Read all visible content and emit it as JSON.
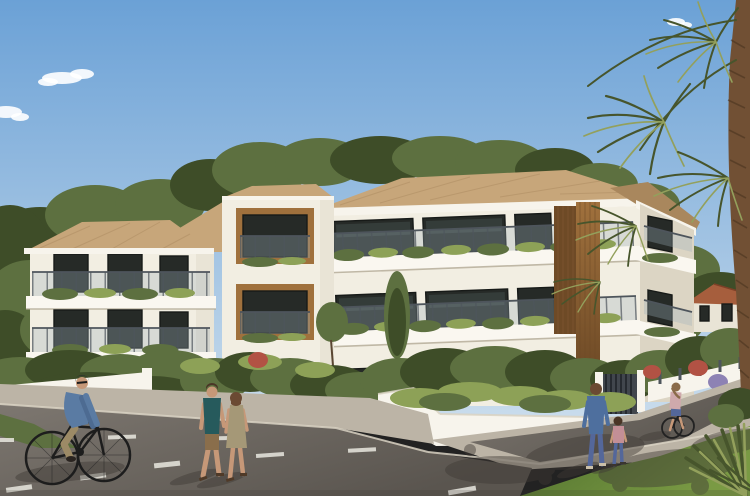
{
  "scene": {
    "setting": "Sunny architectural rendering of a modern three-storey Mediterranean apartment residence on a landscaped street corner",
    "sky": {
      "condition": "clear light-blue sky with a few small white clouds"
    },
    "building": {
      "storeys": 3,
      "facade": "white stucco",
      "roof": "sand-coloured clay tile hip roofs with greenery rising behind the ridges",
      "features": [
        "wrap-around balconies with glass and steel railings",
        "planted balcony edges",
        "vertical timber slat column",
        "timber-framed recessed loggias",
        "large dark-framed windows"
      ]
    },
    "landscape": {
      "elements": [
        "low white garden walls",
        "dense green shrubs and grasses",
        "lavender accents",
        "red flowering shrubs",
        "slim poplar tree",
        "tall fan palm at right edge",
        "agave leaves in the lower-right corner",
        "lawn strip at lower right",
        "grass verge at lower left"
      ]
    },
    "background": {
      "house": "small white house with terracotta tiled roof among trees"
    },
    "street": {
      "surfaces": [
        "asphalt roadway",
        "light concrete sidewalks",
        "corner kerbs"
      ],
      "markings": "white dashed lane lines",
      "shadows": "tree shadows dappling the pavement at lower right"
    },
    "people": [
      {
        "name": "cyclist",
        "description": "man riding a black bicycle",
        "clothing": {
          "cap": "dark",
          "jacket": "blue denim",
          "trousers": "khaki"
        }
      },
      {
        "name": "walking-man",
        "description": "man walking hand in hand",
        "clothing": {
          "shirt": "dark teal tee",
          "shorts": "khaki",
          "shoes": "sandals"
        }
      },
      {
        "name": "walking-woman",
        "description": "woman walking hand in hand",
        "clothing": {
          "dress": "olive sleeveless"
        }
      },
      {
        "name": "mother",
        "description": "woman walking on sidewalk",
        "clothing": {
          "top": "blue",
          "trousers": "jeans"
        }
      },
      {
        "name": "child",
        "description": "little girl beside mother",
        "clothing": {
          "top": "pink",
          "trousers": "jeans"
        }
      },
      {
        "name": "distant-cyclist",
        "description": "young rider on the side street",
        "clothing": {
          "top": "light pink",
          "shorts": "denim"
        }
      }
    ],
    "people_count": 6
  },
  "palette": {
    "sky_top": "#6ba1d6",
    "sky_horizon": "#c9dcec",
    "cloud": "#ffffff",
    "roof_tan": "#c7a67a",
    "roof_shade": "#a9875d",
    "trim_white": "#f7f4ec",
    "wall_lit": "#f2eee2",
    "wall_mid": "#e9e4d6",
    "wall_shade": "#dcd5c4",
    "slab_white": "#faf7f0",
    "slab_shadow": "#b2a995",
    "window_dark": "#262a27",
    "window_reflect": "#4d5a57",
    "window_frame": "#171a18",
    "wood_mid": "#a0713d",
    "wood_dark": "#6e4a26",
    "railing_metal": "#4e555c",
    "railing_glass": "#9fb2ba",
    "green_dark": "#3e4d28",
    "green_mid": "#5d7040",
    "green_light": "#8da157",
    "lavender": "#8d82b4",
    "flower_red": "#b25244",
    "lawn_light": "#7a9a44",
    "lawn_dark": "#4e6e2c",
    "road_light": "#7d7770",
    "road_dark": "#5a554f",
    "road_shadow": "#3f3a35",
    "sidewalk": "#bcb4a6",
    "curb": "#d9d2c3",
    "palm_trunk": "#715034",
    "palm_dark": "#47552c",
    "palm_light": "#93a05c",
    "house_roof": "#a65e3d",
    "skin": "#c69878",
    "denim_jacket": "#5a7ba3",
    "khaki": "#9c8a66",
    "teal_shirt": "#265a5c",
    "shorts_khaki": "#8a6e4b",
    "dress_olive": "#a59877",
    "hair_brown": "#4a3526",
    "hair_auburn": "#6b4a33",
    "mother_top": "#4e6f9e",
    "jeans": "#54679a",
    "child_pink": "#c38f96",
    "rider_pink": "#cfa9ac",
    "bike_frame": "#1d1d1d",
    "gate_gray": "#41464d",
    "cap_dark": "#2c2e30",
    "white_marking": "#e9e7df"
  }
}
